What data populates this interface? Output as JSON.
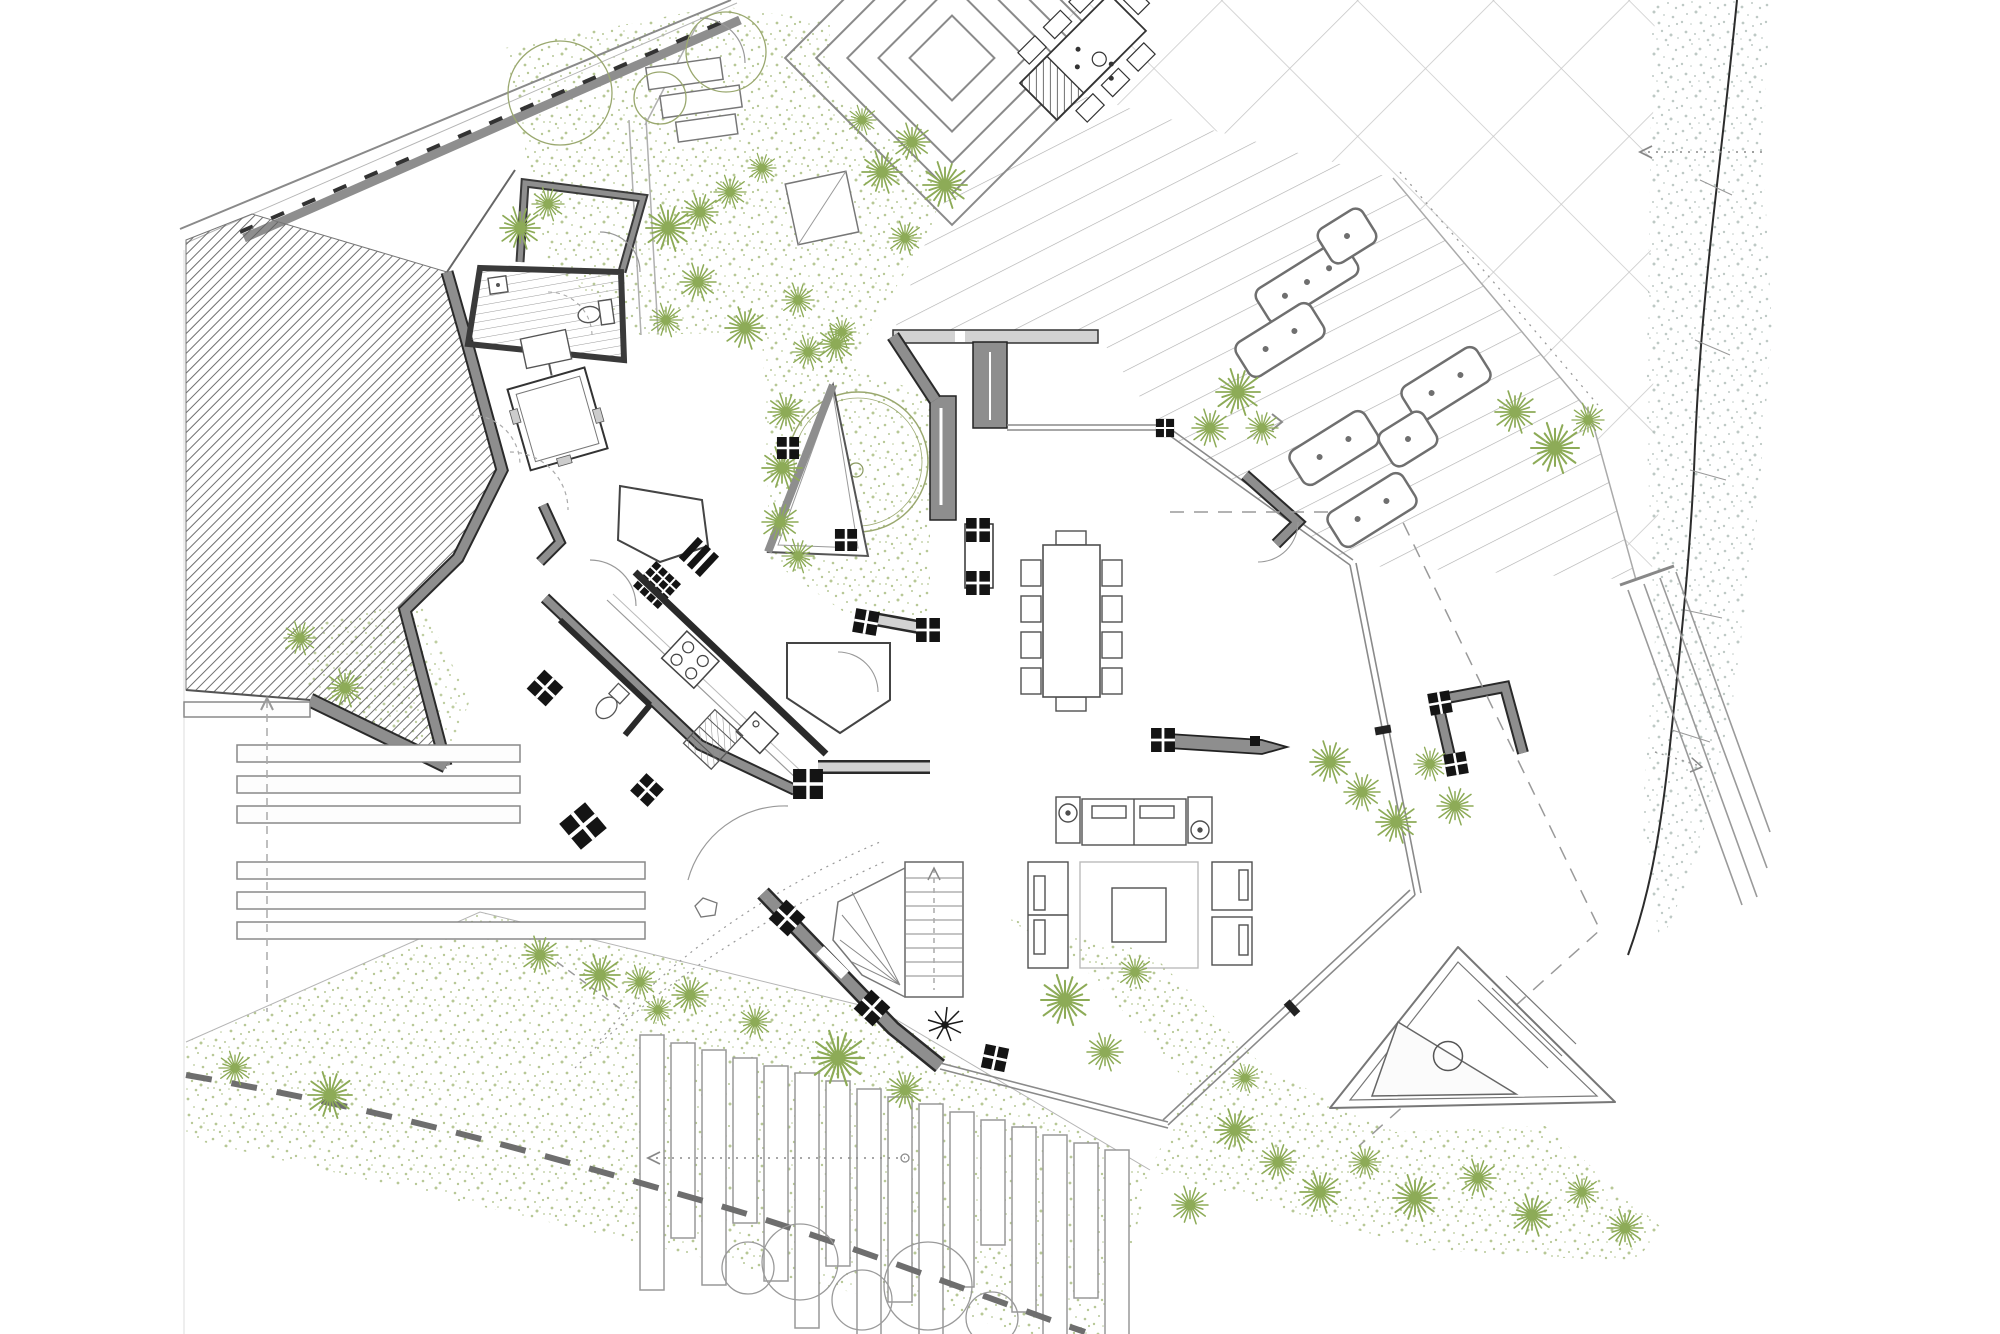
{
  "document": {
    "type": "architectural-site-plan",
    "view": "ground-floor plan with landscape",
    "visible_text": "none"
  },
  "palette": {
    "background": "#ffffff",
    "wall_fill": "#8e8e8e",
    "wall_edge": "#1f1f1f",
    "line_light": "#9f9f9f",
    "line_pale": "#c9c9c9",
    "hatch": "#5f5f5f",
    "stipple_green": "#9fb572",
    "palm_green": "#8dab57",
    "tree_outline": "#9aa86f",
    "dune_gray": "#aebcb6",
    "boundary_dash": "#6e6e6e",
    "furniture_line": "#4f4f4f",
    "glass_line": "#8a8a8a",
    "column_marker": "#141414"
  },
  "areas": {
    "site_plan": {
      "label": "ground floor site plan drawing"
    },
    "property_boundary": {
      "label": "north-west property boundary with retaining wall"
    },
    "slope_planting": {
      "label": "hatched slope embankment"
    },
    "guest_suite": {
      "label": "guest room"
    },
    "guest_bathroom": {
      "label": "bathroom with toilet and basin"
    },
    "glass_cabin": {
      "label": "glazed cabin / sauna box"
    },
    "entry_hall": {
      "label": "entry hall with door swings"
    },
    "kitchen": {
      "label": "kitchen with hob, sink, wc and service stair"
    },
    "staircase": {
      "label": "main staircase with winders"
    },
    "inner_courtyard": {
      "label": "planted inner courtyard with tree",
      "tree_count": 1
    },
    "dining_room": {
      "label": "dining room"
    },
    "dining_table": {
      "label": "dining table",
      "seats": 10
    },
    "living_room": {
      "label": "living room with sofas, rug and coffee table"
    },
    "north_wall": {
      "label": "north wall and clerestory band"
    },
    "glazed_facade": {
      "label": "glazed facades of main volume"
    },
    "outdoor_wall_stub": {
      "label": "free-standing terrace wall with pointed end"
    },
    "outdoor_kitchen_wall": {
      "label": "outdoor walled enclosure"
    },
    "roof_overhang": {
      "label": "dashed roof overhang line"
    },
    "paved_terrace": {
      "label": "diagonal tiled terrace"
    },
    "timber_deck": {
      "label": "timber deck with plank lines"
    },
    "sun_loungers": {
      "label": "sun loungers on deck",
      "count": 7
    },
    "terrace_steps": {
      "label": "stepped terrace landscaping"
    },
    "outdoor_dining": {
      "label": "outdoor dining table",
      "seats": 7
    },
    "garden_shed": {
      "label": "small garden structures"
    },
    "upper_garden": {
      "label": "upper gravel garden with trees"
    },
    "planter_steps": {
      "label": "planter steps on west slope",
      "count": 7
    },
    "timber_boards": {
      "label": "timber board steps on south slope",
      "count": 16
    },
    "gravel_planting": {
      "label": "gravel planting bands"
    },
    "palm_trees": {
      "label": "palm planting",
      "count": 46
    },
    "tree_canopies": {
      "label": "tree canopy outlines",
      "count": 8
    },
    "dune_edge": {
      "label": "stippled dune edge with contour line"
    },
    "exterior_stair": {
      "label": "long exterior stair ramp"
    },
    "spa_feature": {
      "label": "triangular spa / water feature with circular tub"
    },
    "boundary_fence": {
      "label": "dashed south property boundary"
    },
    "section_markers": {
      "label": "dotted section lines with arrows"
    },
    "column_markers": {
      "label": "black column grid markers",
      "count": 18
    }
  }
}
